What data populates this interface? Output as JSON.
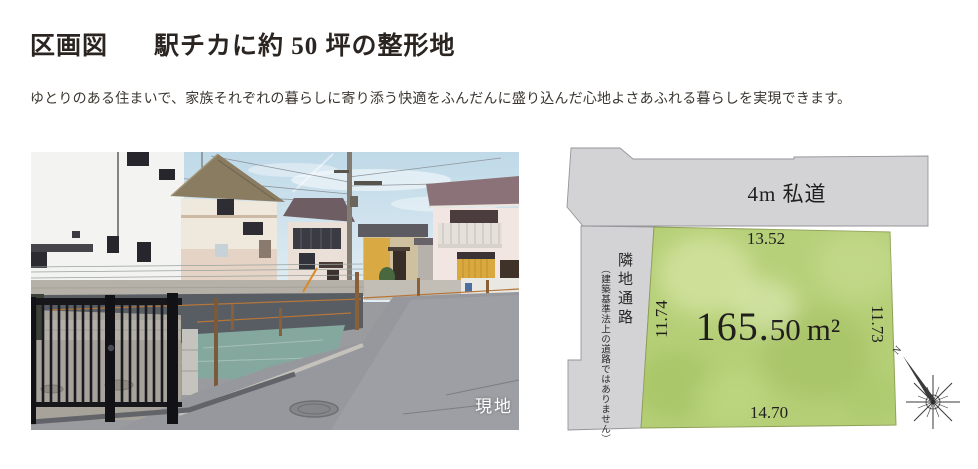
{
  "page": {
    "title_section": "区画図",
    "title_main": "駅チカに約 50 坪の整形地",
    "subtitle": "ゆとりのある住まいで、家族それぞれの暮らしに寄り添う快適をふんだんに盛り込んだ心地よさあふれる暮らしを実現できます。"
  },
  "photo": {
    "caption": "現地"
  },
  "diagram": {
    "road_label": "4m 私道",
    "passage_label": "隣地通路",
    "passage_note": "（建築基準法上の道路ではありません）",
    "dims": {
      "top": "13.52",
      "left": "11.74",
      "right": "11.73",
      "bottom": "14.70"
    },
    "area": {
      "main": "165.",
      "frac": "50",
      "unit": "m²"
    },
    "compass": {
      "north_label": "N"
    },
    "colors": {
      "road_fill": "#d3d3d6",
      "road_stroke": "#96969a",
      "lot_fill": "#b5cf77",
      "lot_stroke": "#8d9e55",
      "text": "#211f1d"
    }
  }
}
